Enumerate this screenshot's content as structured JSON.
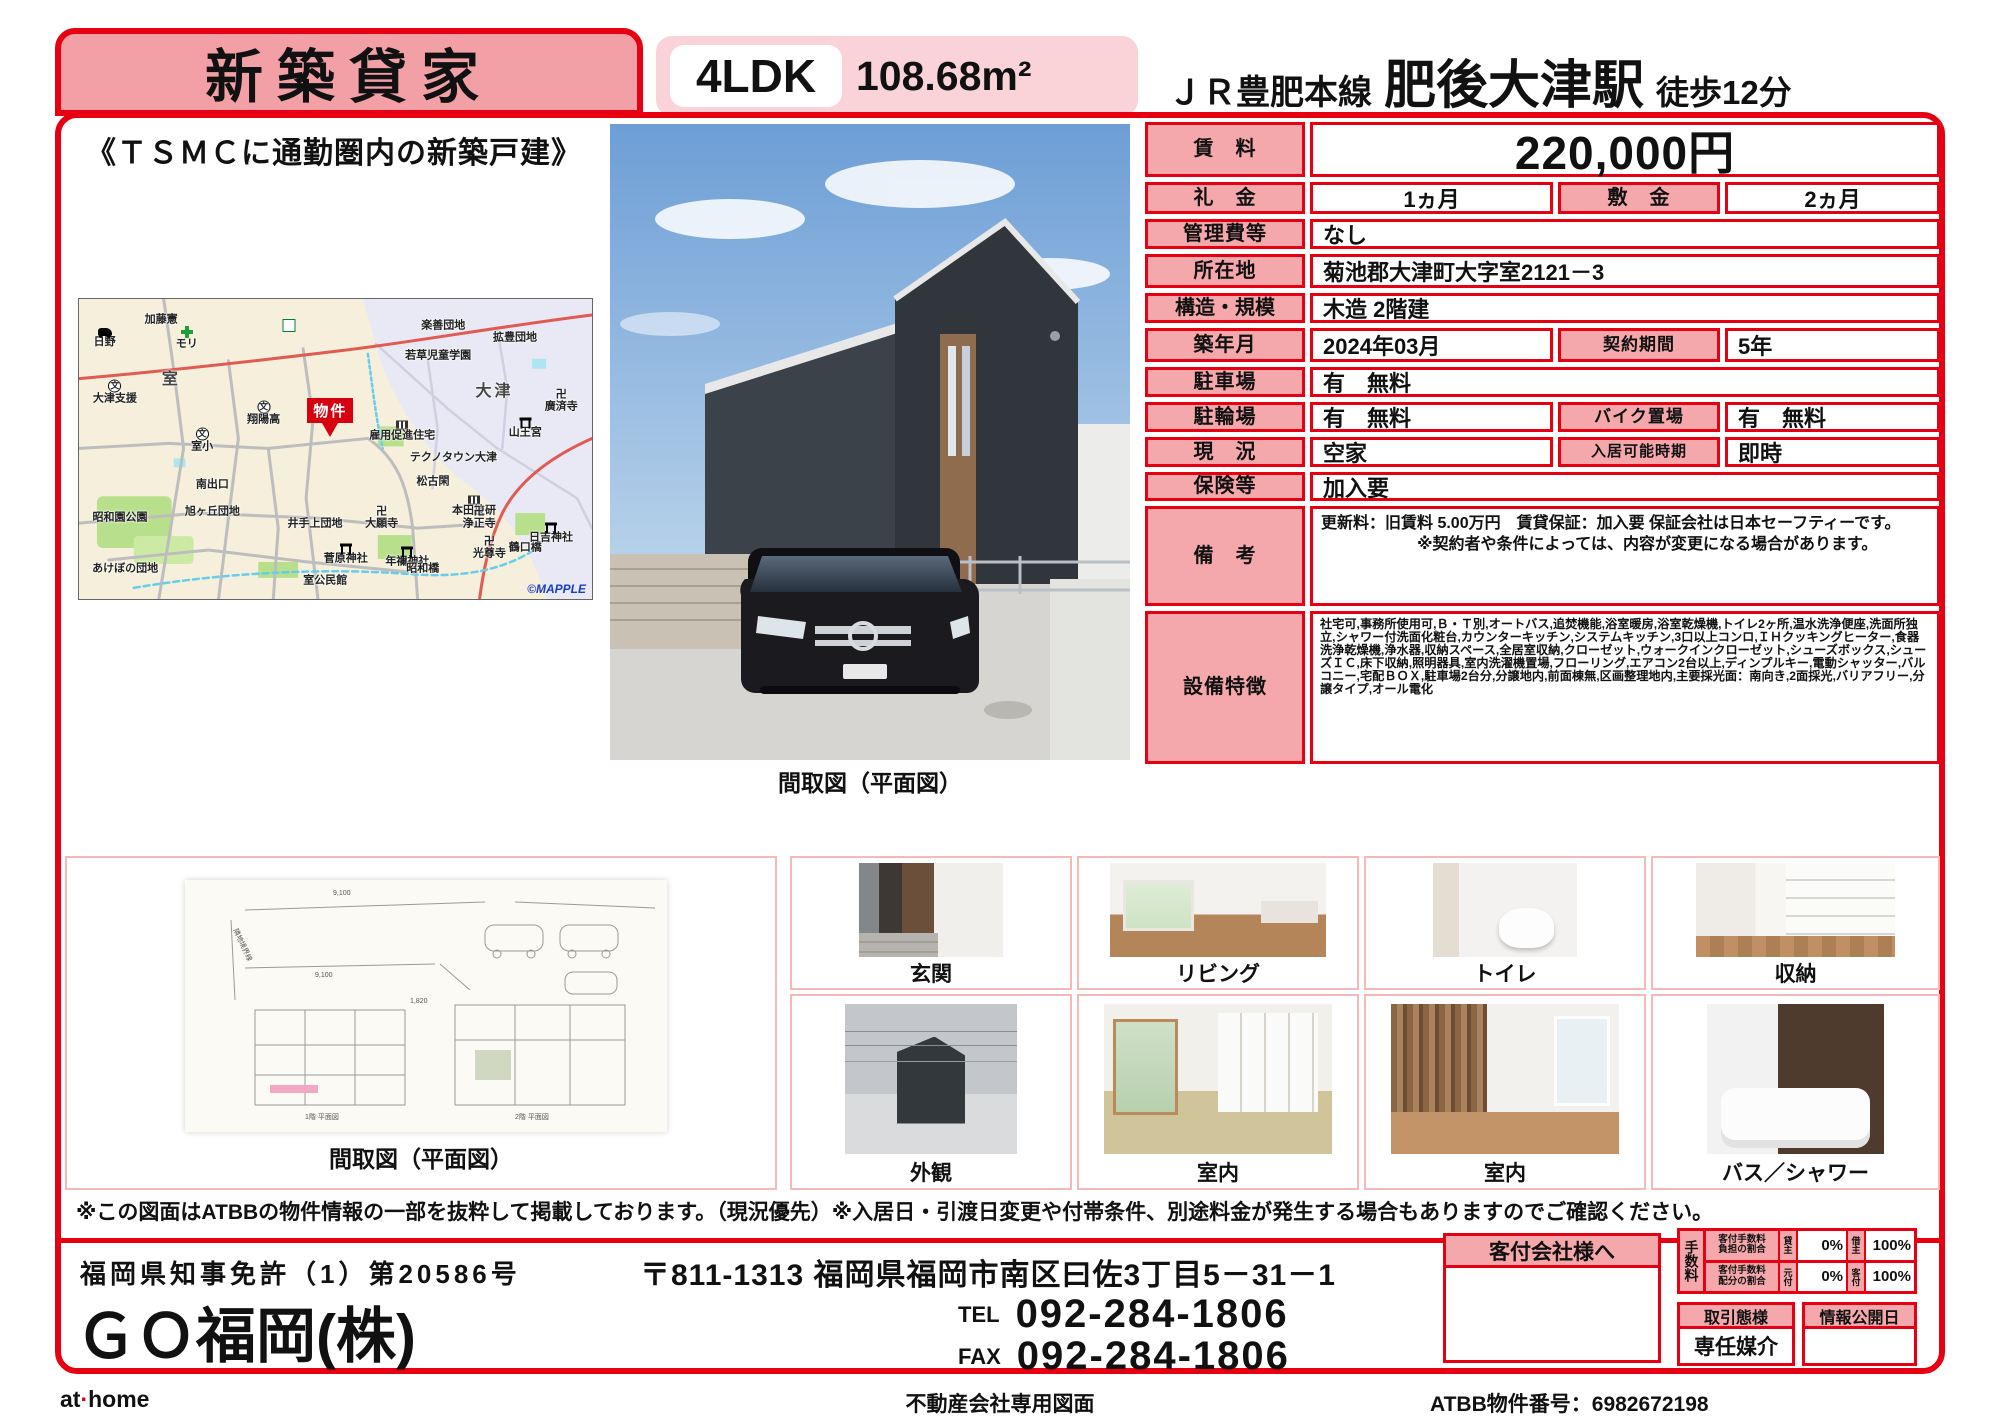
{
  "colors": {
    "accent_red": "#e60012",
    "label_pink": "#f5a8ab",
    "banner_pink": "#f2a0a6",
    "light_pink": "#f9d3d7",
    "property_marker_red": "#d7000f"
  },
  "header": {
    "badge": "新築貸家",
    "layout": "4LDK",
    "area": "108.68m²",
    "rail_line": "ＪＲ豊肥本線",
    "station": "肥後大津駅",
    "walk": "徒歩12分",
    "catchphrase": "《ＴＳＭＣに通勤圏内の新築戸建》"
  },
  "map": {
    "credit": "©MAPPLE",
    "property_marker": "物件",
    "labels": [
      {
        "t": "日野",
        "x": 5,
        "y": 13,
        "ic": "car"
      },
      {
        "t": "加藤憲",
        "x": 16,
        "y": 7
      },
      {
        "t": "モリ",
        "x": 21,
        "y": 13,
        "ic": "cross"
      },
      {
        "t": "7",
        "x": 41,
        "y": 9,
        "ic": "seven"
      },
      {
        "t": "室",
        "x": 18,
        "y": 27,
        "big": true
      },
      {
        "t": "大津支援",
        "x": 7,
        "y": 31,
        "ic": "school"
      },
      {
        "t": "翔陽高",
        "x": 36,
        "y": 38,
        "ic": "school"
      },
      {
        "t": "室小",
        "x": 24,
        "y": 47,
        "ic": "school"
      },
      {
        "t": "若草児童学園",
        "x": 70,
        "y": 19
      },
      {
        "t": "拡豊団地",
        "x": 85,
        "y": 13
      },
      {
        "t": "楽善団地",
        "x": 71,
        "y": 9
      },
      {
        "t": "大津",
        "x": 81,
        "y": 31,
        "big": true
      },
      {
        "t": "廣済寺",
        "x": 94,
        "y": 34,
        "ic": "temple"
      },
      {
        "t": "山王宮",
        "x": 87,
        "y": 43,
        "ic": "torii"
      },
      {
        "t": "雇用促進住宅",
        "x": 63,
        "y": 44,
        "ic": "bldg"
      },
      {
        "t": "テクノタウン大津",
        "x": 73,
        "y": 53
      },
      {
        "t": "松古閑",
        "x": 69,
        "y": 61
      },
      {
        "t": "本田技研",
        "x": 77,
        "y": 69,
        "ic": "bldg"
      },
      {
        "t": "南出口",
        "x": 26,
        "y": 62
      },
      {
        "t": "昭和園公園",
        "x": 8,
        "y": 73
      },
      {
        "t": "旭ヶ丘団地",
        "x": 26,
        "y": 71
      },
      {
        "t": "井手上団地",
        "x": 46,
        "y": 75
      },
      {
        "t": "大願寺",
        "x": 59,
        "y": 73,
        "ic": "temple"
      },
      {
        "t": "菅原神社",
        "x": 52,
        "y": 85,
        "ic": "torii"
      },
      {
        "t": "年禰神社",
        "x": 64,
        "y": 86,
        "ic": "torii"
      },
      {
        "t": "あけぼの団地",
        "x": 9,
        "y": 90
      },
      {
        "t": "室公民館",
        "x": 48,
        "y": 94
      },
      {
        "t": "浄正寺",
        "x": 78,
        "y": 73,
        "ic": "temple"
      },
      {
        "t": "光尊寺",
        "x": 80,
        "y": 83,
        "ic": "temple"
      },
      {
        "t": "鶴口橋",
        "x": 87,
        "y": 83
      },
      {
        "t": "日吉神社",
        "x": 92,
        "y": 78,
        "ic": "torii"
      },
      {
        "t": "昭和橋",
        "x": 67,
        "y": 90
      }
    ],
    "marker_pos": {
      "x": 49,
      "y": 46
    }
  },
  "main_photo": {
    "caption": "間取図（平面図）"
  },
  "details": {
    "rent_label": "賃　料",
    "rent_value": "220,000円",
    "reikin_label": "礼　金",
    "reikin_value": "1ヵ月",
    "shikikin_label": "敷　金",
    "shikikin_value": "2ヵ月",
    "kanrihi_label": "管理費等",
    "kanrihi_value": "なし",
    "address_label": "所在地",
    "address_value": "菊池郡大津町大字室2121－3",
    "structure_label": "構造・規模",
    "structure_value": "木造 2階建",
    "built_label": "築年月",
    "built_value": "2024年03月",
    "contract_label": "契約期間",
    "contract_value": "5年",
    "parking_label": "駐車場",
    "parking_value": "有　無料",
    "bicycle_label": "駐輪場",
    "bicycle_value": "有　無料",
    "bike_label": "バイク置場",
    "bike_value": "有　無料",
    "status_label": "現　況",
    "status_value": "空家",
    "movein_label": "入居可能時期",
    "movein_value": "即時",
    "insurance_label": "保険等",
    "insurance_value": "加入要",
    "notes_label": "備　考",
    "notes_value": "更新料：旧賃料 5.00万円　賃貸保証：加入要 保証会社は日本セーフティーです。\n　　　　　　※契約者や条件によっては、内容が変更になる場合があります。",
    "features_label": "設備特徴",
    "features_value": "社宅可,事務所使用可,Ｂ・Ｔ別,オートバス,追焚機能,浴室暖房,浴室乾燥機,トイレ2ヶ所,温水洗浄便座,洗面所独立,シャワー付洗面化粧台,カウンターキッチン,システムキッチン,3口以上コンロ,ＩＨクッキングヒーター,食器洗浄乾燥機,浄水器,収納スペース,全居室収納,クローゼット,ウォークインクローゼット,シューズボックス,シューズＩＣ,床下収納,照明器具,室内洗濯機置場,フローリング,エアコン2台以上,ディンプルキー,電動シャッター,バルコニー,宅配ＢＯＸ,駐車場2台分,分譲地内,前面棟無,区画整理地内,主要採光面：南向き,2面採光,バリアフリー,分譲タイプ,オール電化"
  },
  "gallery": {
    "floorplan_caption": "間取図（平面図）",
    "floorplan_annotations": [
      "隣地境界線",
      "9,100",
      "1,820",
      "910",
      "1階 平面図",
      "2階 平面図"
    ],
    "photos": [
      {
        "caption": "玄関"
      },
      {
        "caption": "リビング"
      },
      {
        "caption": "トイレ"
      },
      {
        "caption": "収納"
      },
      {
        "caption": "外観"
      },
      {
        "caption": "室内"
      },
      {
        "caption": "室内"
      },
      {
        "caption": "バス／シャワー"
      }
    ]
  },
  "disclaimer": "※この図面はATBBの物件情報の一部を抜粋して掲載しております。（現況優先）※入居日・引渡日変更や付帯条件、別途料金が発生する場合もありますのでご確認ください。",
  "footer": {
    "license": "福岡県知事免許（1）第20586号",
    "company": "ＧＯ福岡(株)",
    "address": "〒811-1313 福岡県福岡市南区曰佐3丁目5－31－1",
    "tel_label": "TEL",
    "tel": "092-284-1806",
    "fax_label": "FAX",
    "fax": "092-284-1806",
    "kyakufu_header": "客付会社様へ",
    "fee": {
      "title": "手数料",
      "rows": [
        {
          "name": "客付手数料\n負担の割合",
          "p1": "貸主",
          "v1": "0%",
          "p2": "借主",
          "v2": "100%"
        },
        {
          "name": "客付手数料\n配分の割合",
          "p1": "元付",
          "v1": "0%",
          "p2": "客付",
          "v2": "100%"
        }
      ]
    },
    "torihiki_label": "取引態様",
    "torihiki_value": "専任媒介",
    "joho_label": "情報公開日",
    "joho_value": ""
  },
  "bottom_bar": {
    "logo": "at home",
    "center": "不動産会社専用図面",
    "right": "ATBB物件番号：6982672198"
  }
}
